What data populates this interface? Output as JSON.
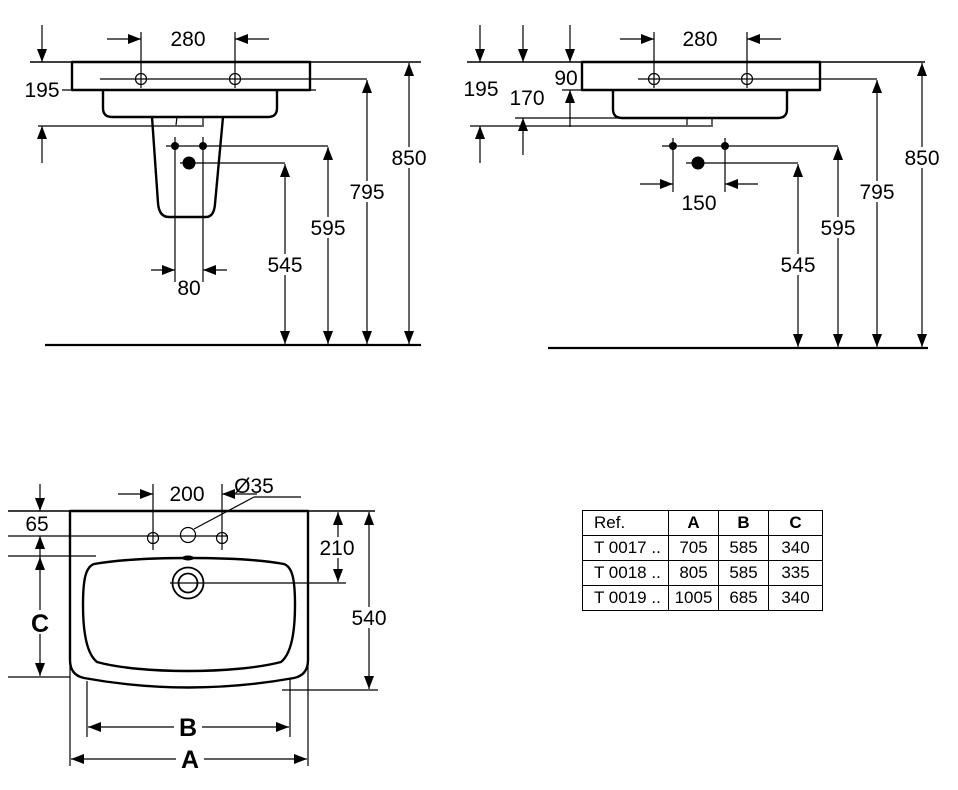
{
  "pedestal_view": {
    "d280": "280",
    "d195": "195",
    "d80": "80",
    "d545": "545",
    "d595": "595",
    "d795": "795",
    "d850": "850"
  },
  "wall_view": {
    "d280": "280",
    "d195": "195",
    "d170": "170",
    "d90": "90",
    "d150": "150",
    "d545": "545",
    "d595": "595",
    "d795": "795",
    "d850": "850"
  },
  "plan_view": {
    "d200": "200",
    "d35": "Ø35",
    "d65": "65",
    "d210": "210",
    "d540": "540",
    "a": "A",
    "b": "B",
    "c": "C"
  },
  "table": {
    "headers": [
      "Ref.",
      "A",
      "B",
      "C"
    ],
    "rows": [
      [
        "T 0017 ..",
        "705",
        "585",
        "340"
      ],
      [
        "T 0018 ..",
        "805",
        "585",
        "335"
      ],
      [
        "T 0019 ..",
        "1005",
        "685",
        "340"
      ]
    ]
  }
}
